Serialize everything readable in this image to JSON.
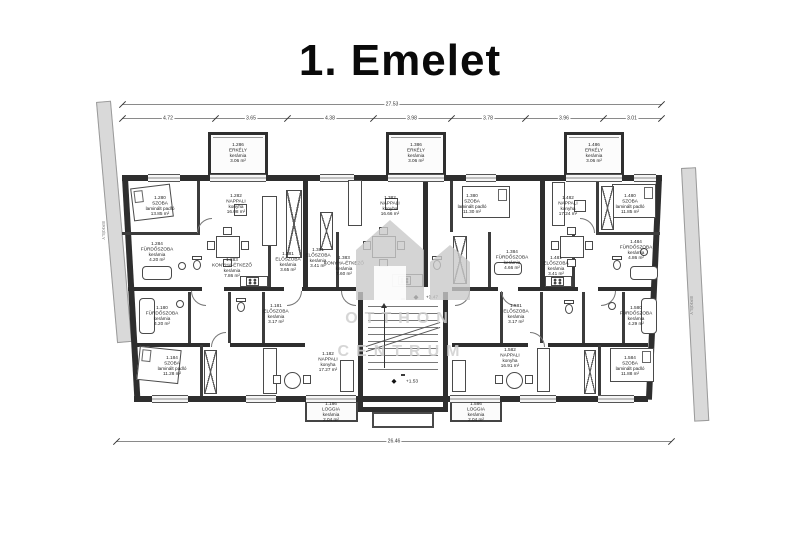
{
  "title": "1. Emelet",
  "watermark": {
    "line1": "OTTHON",
    "line2": "CENTRUM"
  },
  "dims": {
    "top_total": "27.53",
    "top_segments": [
      "4.72",
      "3.65",
      "4.38",
      "3.98",
      "3.78",
      "3.96",
      "3.01"
    ],
    "bottom_total": "26.46"
  },
  "side_strips": {
    "left": "ERKÉLY",
    "right": "ERKÉLY"
  },
  "stairwell": {
    "upper_level": "+3.47",
    "lower_level": "+1.53"
  },
  "apartments": [
    {
      "position": "top-left",
      "rooms": [
        {
          "id": "1.280",
          "name": "SZOBA",
          "finish": "laminált padló",
          "area": "13.85 m²"
        },
        {
          "id": "1.282",
          "name": "NAPPALI",
          "finish": "konyha",
          "area": "16.08 m²"
        },
        {
          "id": "1.283",
          "name": "KONYHA-ÉTKEZŐ",
          "finish": "kerámia",
          "area": "7.86 m²"
        },
        {
          "id": "1.281",
          "name": "ELŐSZOBA",
          "finish": "kerámia",
          "area": "3.65 m²"
        },
        {
          "id": "1.284",
          "name": "FÜRDŐSZOBA",
          "finish": "kerámia",
          "area": "4.20 m²"
        },
        {
          "id": "1.286",
          "name": "ERKÉLY",
          "finish": "kerámia",
          "area": "3.06 m²"
        }
      ]
    },
    {
      "position": "top-middle",
      "rooms": [
        {
          "id": "1.382",
          "name": "NAPPALI",
          "finish": "konyha",
          "area": "16.66 m²"
        },
        {
          "id": "1.380",
          "name": "SZOBA",
          "finish": "laminált padló",
          "area": "11.30 m²"
        },
        {
          "id": "1.383",
          "name": "KONYHA-ÉTKEZŐ",
          "finish": "kerámia",
          "area": "7.60 m²"
        },
        {
          "id": "1.381",
          "name": "ELŐSZOBA",
          "finish": "kerámia",
          "area": "3.41 m²"
        },
        {
          "id": "1.384",
          "name": "FÜRDŐSZOBA",
          "finish": "kerámia",
          "area": "4.66 m²"
        },
        {
          "id": "1.386",
          "name": "ERKÉLY",
          "finish": "kerámia",
          "area": "3.06 m²"
        }
      ]
    },
    {
      "position": "top-right",
      "rooms": [
        {
          "id": "1.482",
          "name": "NAPPALI",
          "finish": "konyha",
          "area": "17.24 m²"
        },
        {
          "id": "1.480",
          "name": "SZOBA",
          "finish": "laminált padló",
          "area": "11.85 m²"
        },
        {
          "id": "1.481",
          "name": "ELŐSZOBA",
          "finish": "kerámia",
          "area": "3.41 m²"
        },
        {
          "id": "1.484",
          "name": "FÜRDŐSZOBA",
          "finish": "kerámia",
          "area": "4.86 m²"
        },
        {
          "id": "1.486",
          "name": "ERKÉLY",
          "finish": "kerámia",
          "area": "3.06 m²"
        }
      ]
    },
    {
      "position": "bottom-left",
      "rooms": [
        {
          "id": "1.184",
          "name": "SZOBA",
          "finish": "laminált padló",
          "area": "11.28 m²"
        },
        {
          "id": "1.182",
          "name": "NAPPALI",
          "finish": "konyha",
          "area": "17.27 m²"
        },
        {
          "id": "1.181",
          "name": "ELŐSZOBA",
          "finish": "kerámia",
          "area": "3.17 m²"
        },
        {
          "id": "1.180",
          "name": "FÜRDŐSZOBA",
          "finish": "kerámia",
          "area": "4.20 m²"
        },
        {
          "id": "1.186",
          "name": "LOGGIA",
          "finish": "kerámia",
          "area": "2.04 m²"
        }
      ]
    },
    {
      "position": "bottom-right",
      "rooms": [
        {
          "id": "1.582",
          "name": "NAPPALI",
          "finish": "konyha",
          "area": "16.91 m²"
        },
        {
          "id": "1.584",
          "name": "SZOBA",
          "finish": "laminált padló",
          "area": "11.88 m²"
        },
        {
          "id": "1.581",
          "name": "ELŐSZOBA",
          "finish": "kerámia",
          "area": "3.17 m²"
        },
        {
          "id": "1.580",
          "name": "FÜRDŐSZOBA",
          "finish": "kerámia",
          "area": "4.29 m²"
        },
        {
          "id": "1.586",
          "name": "LOGGIA",
          "finish": "kerámia",
          "area": "2.04 m²"
        }
      ]
    }
  ]
}
